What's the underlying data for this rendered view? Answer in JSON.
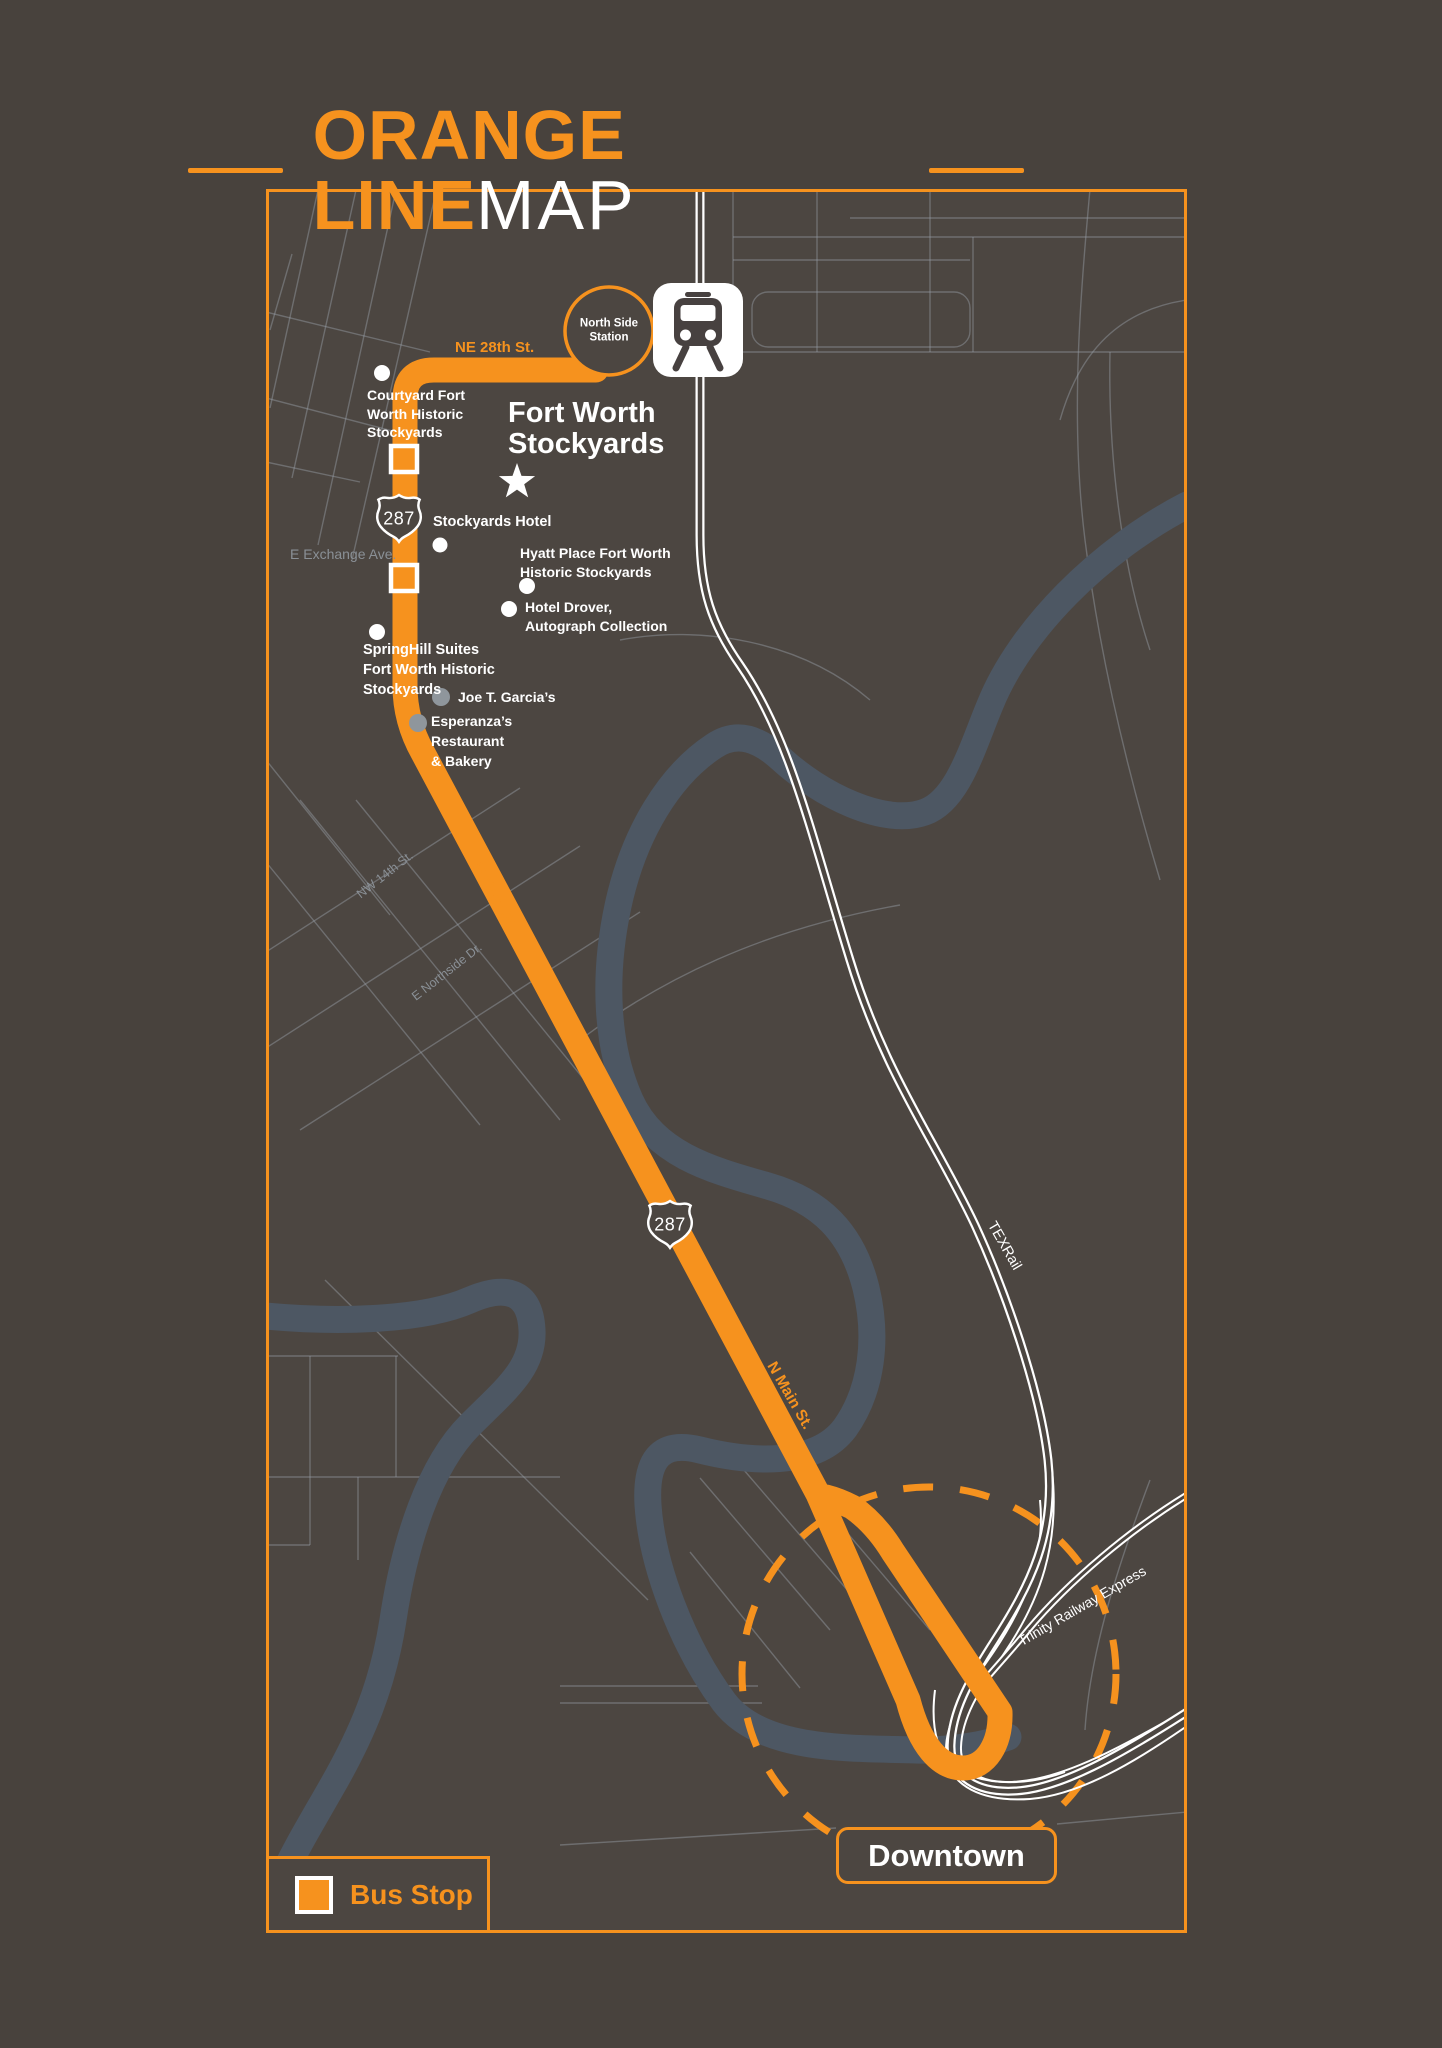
{
  "title": {
    "part1": "ORANGE LINE",
    "part2": "MAP"
  },
  "legend": {
    "bus_stop_label": "Bus Stop"
  },
  "downtown_label": "Downtown",
  "station": {
    "name": "North Side\nStation"
  },
  "area_heading": "Fort Worth\nStockyards",
  "shields": {
    "shield1": "287",
    "shield2": "287"
  },
  "route_labels": {
    "ne_28th": "NE 28th St.",
    "n_main_1": "N Main St.",
    "n_main_2": "N Main St."
  },
  "street_labels": {
    "e_exchange": "E Exchange Ave.",
    "nw_14th": "NW 14th St.",
    "e_northside": "E Northside Dr."
  },
  "rail_labels": {
    "texrail": "TEXRail",
    "tre": "Trinity Railway Express"
  },
  "pois": {
    "courtyard": "Courtyard Fort\nWorth Historic\nStockyards",
    "stockyards_hotel": "Stockyards Hotel",
    "hyatt": "Hyatt Place Fort Worth\nHistoric Stockyards",
    "drover": "Hotel Drover,\nAutograph Collection",
    "springhill": "SpringHill Suites\nFort Worth Historic\nStockyards",
    "joe_t": "Joe T. Garcia’s",
    "esperanza": "Esperanza’s\nRestaurant\n& Bakery"
  },
  "colors": {
    "accent_orange": "#f6921e",
    "page_background": "#48423d",
    "map_background": "#4c4641",
    "river": "#4d5763",
    "street_line": "#98a0a8",
    "rail_white": "#ffffff",
    "muted_dot": "#8f969c",
    "street_label_gray": "#8a9096"
  },
  "icons": {
    "train_station": "train-station-icon",
    "star": "star-icon",
    "bus_stop": "bus-stop-square"
  }
}
